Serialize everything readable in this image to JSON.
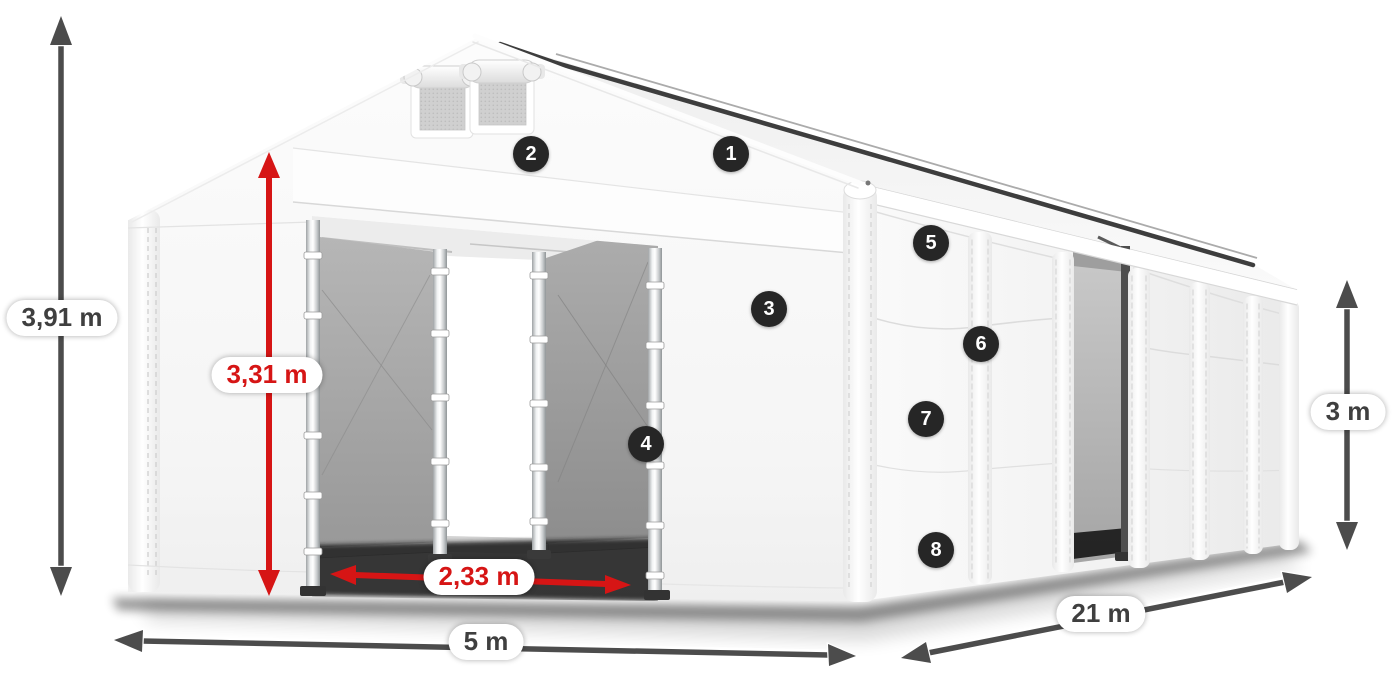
{
  "diagram": {
    "description": "White tarpaulin storage tent shown in perspective with dimension arrows and numbered part markers"
  },
  "dimensions": {
    "total_height": "3,91 m",
    "inner_height": "3,31 m",
    "door_width": "2,33 m",
    "width": "5 m",
    "length": "21 m",
    "wall_height": "3 m"
  },
  "markers": {
    "m1": "1",
    "m2": "2",
    "m3": "3",
    "m4": "4",
    "m5": "5",
    "m6": "6",
    "m7": "7",
    "m8": "8"
  },
  "colors": {
    "accent_red": "#d61515",
    "arrow_dark": "#4c4c4c",
    "badge_bg": "#262626"
  }
}
